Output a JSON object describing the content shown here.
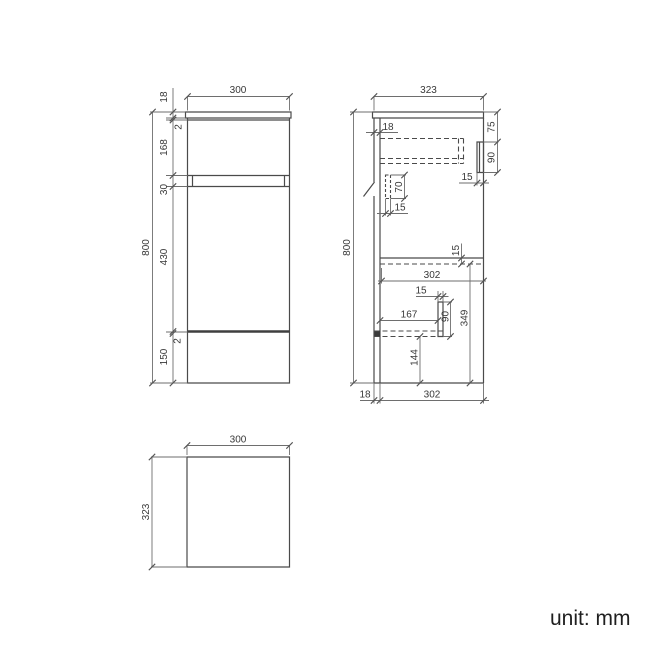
{
  "front_view": {
    "width": "300",
    "top_thickness": "18",
    "top_gap": "2",
    "upper_panel": "168",
    "rail": "30",
    "door": "430",
    "bottom_gap": "2",
    "plinth": "150",
    "height": "800"
  },
  "side_view": {
    "depth": "323",
    "back_thickness": "18",
    "front_offset": "75",
    "front_panel_height": "90",
    "front_panel_thickness": "15",
    "bracket_height": "70",
    "bracket_thickness": "15",
    "height": "800",
    "shelf_thickness": "15",
    "inner_depth": "302",
    "divider_thickness": "15",
    "shelf_depth": "167",
    "divider_height": "90",
    "lower_height": "349",
    "plinth_height": "144",
    "back_bottom": "18",
    "bottom_depth": "302"
  },
  "top_view": {
    "width": "300",
    "depth": "323"
  },
  "footer": {
    "unit_label": "unit: mm"
  }
}
